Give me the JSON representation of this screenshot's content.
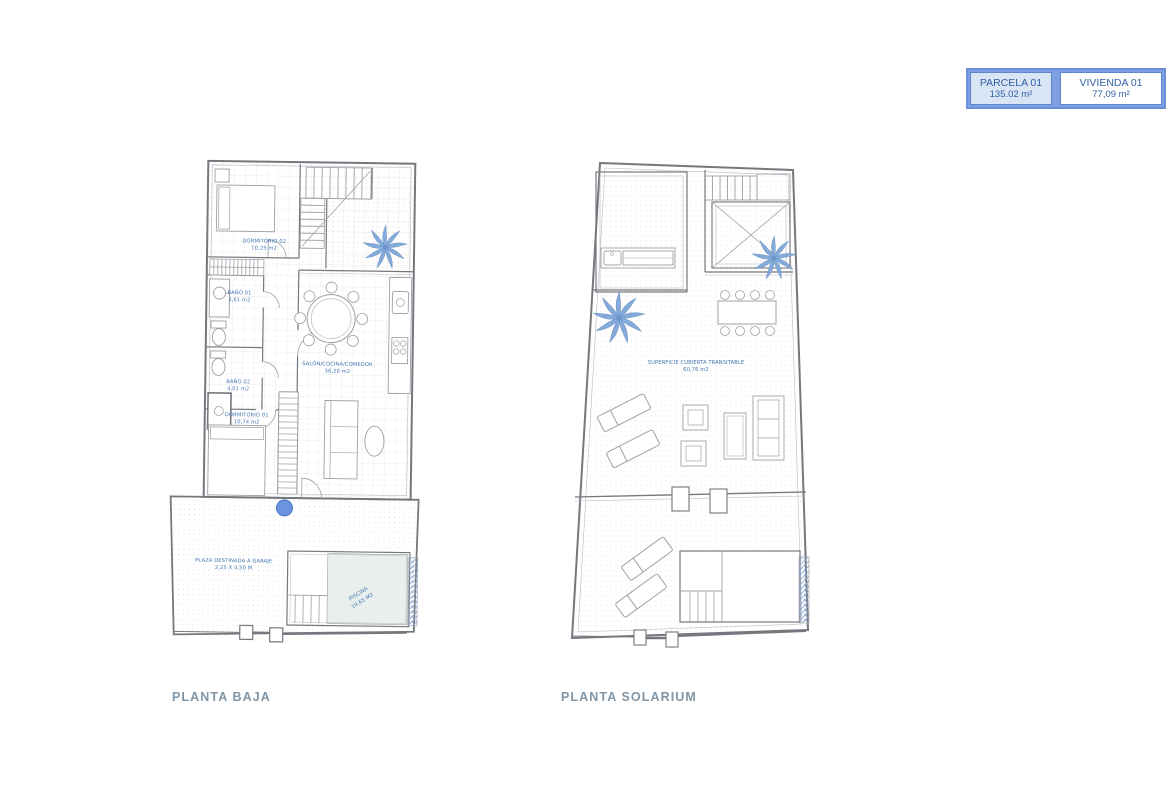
{
  "legend": {
    "parcela": {
      "label": "PARCELA 01",
      "area": "135.02 m²"
    },
    "vivienda": {
      "label": "VIVIENDA 01",
      "area": "77,09 m²"
    }
  },
  "plans": {
    "planta_baja": {
      "title": "PLANTA BAJA",
      "rooms": [
        {
          "name": "DORMITORIO 02",
          "area": "10,25 m2"
        },
        {
          "name": "BAÑO 01",
          "area": "3,61 m2"
        },
        {
          "name": "BAÑO 02",
          "area": "4,01 m2"
        },
        {
          "name": "SALÓN/COCINA/COMEDOR",
          "area": "36,20 m2"
        },
        {
          "name": "DORMITORIO 01",
          "area": "10,74 m2"
        },
        {
          "name": "PLAZA DESTINADA A GARAJE",
          "area": "2,25 X 4,50 M"
        },
        {
          "name": "PISCINA",
          "area": "10,65 M2"
        }
      ]
    },
    "planta_solarium": {
      "title": "PLANTA SOLARIUM",
      "rooms": [
        {
          "name": "SUPERFICIE CUBIERTA TRANSITABLE",
          "area": "60,76 m2"
        }
      ]
    }
  },
  "colors": {
    "label_blue": "#4577b4",
    "title_gray_blue": "#8096a6",
    "legend_border": "#6b90d8",
    "legend_band": "#7e9fe2",
    "legend_cell_bg": "#d9e5f5",
    "legend_text": "#2f5fa5",
    "wall_line": "#74787e",
    "palm_blue": "#84aad9",
    "pool_water": "#e9efec",
    "plant_strip_blue": "#8aa9d6",
    "tree_dot_blue": "#6b94de"
  }
}
